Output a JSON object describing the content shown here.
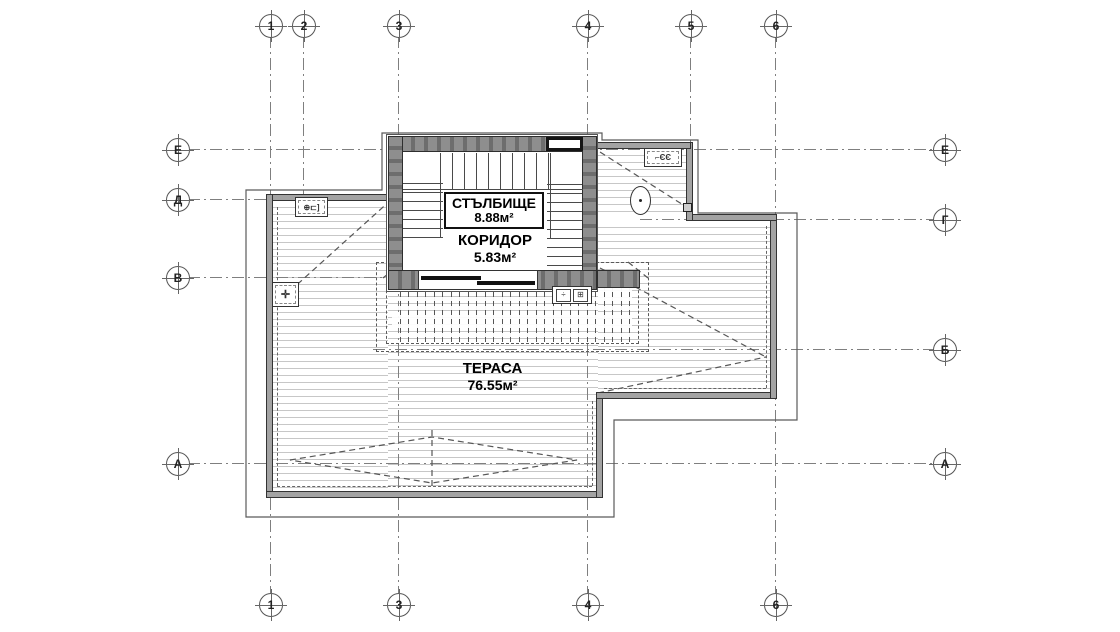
{
  "drawing": {
    "type": "architectural-roof-terrace-floor-plan",
    "language": "Bulgarian"
  },
  "grid_markers": {
    "top": [
      "1",
      "2",
      "3",
      "4",
      "5",
      "6"
    ],
    "bottom": [
      "1",
      "3",
      "4",
      "6"
    ],
    "left": [
      "Е",
      "Д",
      "В",
      "А"
    ],
    "right": [
      "Е",
      "Г",
      "Б",
      "А"
    ]
  },
  "rooms": {
    "staircase": {
      "name": "СТЪЛБИЩЕ",
      "area": "8.88м²"
    },
    "corridor": {
      "name": "КОРИДОР",
      "area": "5.83м²"
    },
    "terrace": {
      "name": "ТЕРАСА",
      "area": "76.55м²"
    }
  },
  "symbols": {
    "skylight_glyph": "⌐ЄЄ",
    "vent_glyph": "⊕⊏]",
    "drain_glyph": "✛",
    "fixture_glyph_a": "÷",
    "fixture_glyph_b": "⊞"
  },
  "colors": {
    "line": "#333333",
    "wall_fill": "#8e8e8e",
    "hatch": "#c7c7c7",
    "grid": "#7f7f7f",
    "background": "#ffffff"
  }
}
